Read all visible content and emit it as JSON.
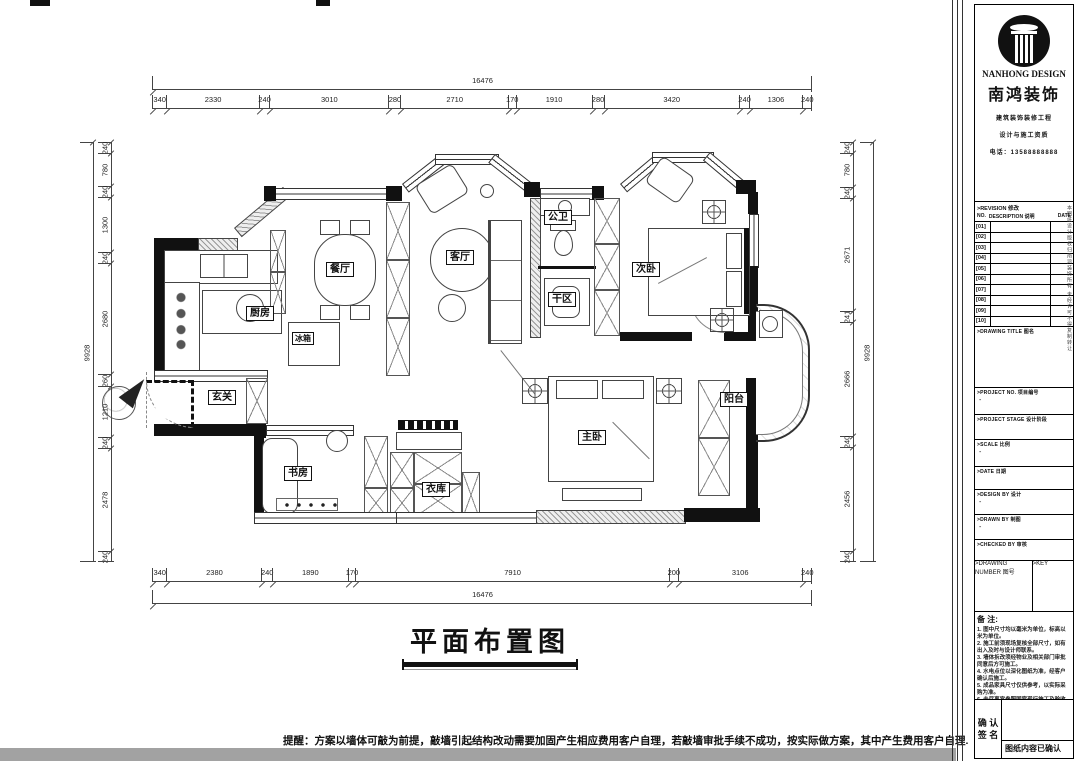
{
  "plan": {
    "title": "平面布置图",
    "rooms": [
      {
        "label": "厨房"
      },
      {
        "label": "冰箱"
      },
      {
        "label": "餐厅"
      },
      {
        "label": "客厅"
      },
      {
        "label": "公卫"
      },
      {
        "label": "干区"
      },
      {
        "label": "次卧"
      },
      {
        "label": "玄关"
      },
      {
        "label": "书房"
      },
      {
        "label": "衣库"
      },
      {
        "label": "主卧"
      },
      {
        "label": "阳台"
      }
    ],
    "note": "提醒：方案以墙体可敲为前提，敲墙引起结构改动需要加固产生相应费用客户自理，若敲墙审批手续不成功，按实际做方案，其中产生费用客户自理."
  },
  "dimensions": {
    "top": {
      "total": "16476",
      "segments": [
        "340",
        "2330",
        "240",
        "3010",
        "280",
        "2710",
        "170",
        "1910",
        "280",
        "3420",
        "240",
        "1306",
        "240"
      ]
    },
    "bottom": {
      "total": "16476",
      "segments": [
        "340",
        "2380",
        "240",
        "1890",
        "170",
        "7910",
        "200",
        "3106",
        "240"
      ]
    },
    "left": {
      "total": "9928",
      "segments": [
        "240",
        "780",
        "240",
        "1300",
        "240",
        "2680",
        "260",
        "1210",
        "240",
        "2478",
        "240"
      ]
    },
    "right": {
      "total": "9928",
      "segments": [
        "240",
        "780",
        "240",
        "2671",
        "241",
        "2666",
        "240",
        "2456",
        "240"
      ]
    }
  },
  "panel": {
    "logo_en": "NANHONG DESIGN",
    "logo_cn": "南鸿装饰",
    "sub_lines": [
      "建筑装饰装修工程",
      "设计与施工资质",
      "电话：13588888888"
    ],
    "revision": {
      "title": ">REVISION 修改",
      "col_no": "NO.",
      "col_desc": "DESCRIPTION 说明",
      "col_date": "DATE",
      "rows": [
        "[01]",
        "[02]",
        "[03]",
        "[04]",
        "[05]",
        "[06]",
        "[07]",
        "[08]",
        "[09]",
        "[10]"
      ]
    },
    "fields": [
      {
        "label": ">DRAWING TITLE  图名",
        "value": ""
      },
      {
        "label": ">PROJECT NO.  项目编号",
        "value": "-"
      },
      {
        "label": ">PROJECT STAGE  设计阶段",
        "value": ""
      },
      {
        "label": ">SCALE  比例",
        "value": "-"
      },
      {
        "label": ">DATE  日期",
        "value": ""
      },
      {
        "label": ">DESIGN BY  设计",
        "value": "-"
      },
      {
        "label": ">DRAWN BY  制图",
        "value": "-"
      },
      {
        "label": ">CHECKED BY  审核",
        "value": ""
      }
    ],
    "dn_label": ">DRAWING NUMBER  图号",
    "key_label": ">KEY",
    "notes_title": "备 注:",
    "notes": [
      "1. 图中尺寸均以毫米为单位，标高以米为单位。",
      "2. 施工前须现场复核全部尺寸，如有出入及时与设计师联系。",
      "3. 墙体拆改须经物业及相关部门审批同意后方可施工。",
      "4. 水电点位以深化图纸为准，经客户确认后施工。",
      "5. 成品家具尺寸仅供参考，以实际采购为准。",
      "6. 未尽事宜参照国家现行施工及验收规范执行。"
    ],
    "side_text": "本图纸设计版权归南鸿装饰所有 未经许可不得复制转让",
    "confirm": {
      "line1": "确 认",
      "line2": "签 名",
      "note": "图纸内容已确认"
    }
  }
}
